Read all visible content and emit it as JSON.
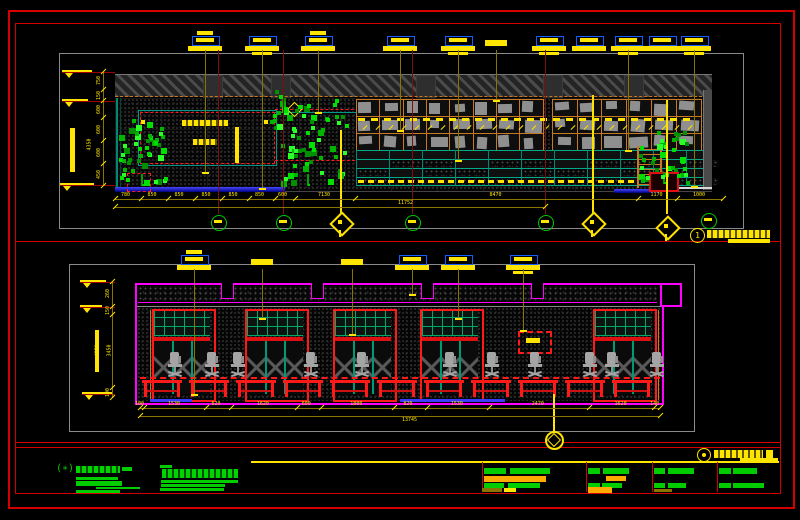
{
  "sheet": {
    "background": "#000000",
    "border_color": "#d40000"
  },
  "top_view": {
    "title_bubble_number": "1",
    "left_dim": {
      "segments": [
        "750",
        "150",
        "600",
        "600",
        "600",
        "450"
      ],
      "total": "4350"
    },
    "bottom_dim_tier1": [
      "780",
      "850",
      "850",
      "850",
      "850",
      "850",
      "600",
      "7130",
      "8470",
      "1170",
      "1000"
    ],
    "bottom_dim_tier2_total": "11752"
  },
  "bottom_view": {
    "left_dim": {
      "segments": [
        "260",
        "150",
        "3450",
        "100"
      ],
      "total": "4850"
    },
    "bottom_dim": [
      "100",
      "1530",
      "620",
      "1620",
      "600",
      "1800",
      "820",
      "1530",
      "2470",
      "1620",
      "140"
    ],
    "bottom_dim_total": "13745"
  },
  "palette": {
    "border_red": "#d40000",
    "frame_red": "#ff1a1a",
    "magenta": "#ff00ff",
    "yellow": "#ffe400",
    "olive": "#8a7400",
    "dark_red_leader": "#7a1010",
    "callout_blue": "#155fff",
    "shelf_orange": "#c87820",
    "teal": "#00aa88",
    "teal_grid": "#00aa66",
    "tree_green": "#00d000",
    "note_green": "#00cc00",
    "value_orange": "#ffaa00",
    "chair_gray": "#a5a5a5",
    "floor_blue": "#3c3cff",
    "viewport_gray": "#8a8a8a",
    "dim_text": "#ffe400"
  }
}
